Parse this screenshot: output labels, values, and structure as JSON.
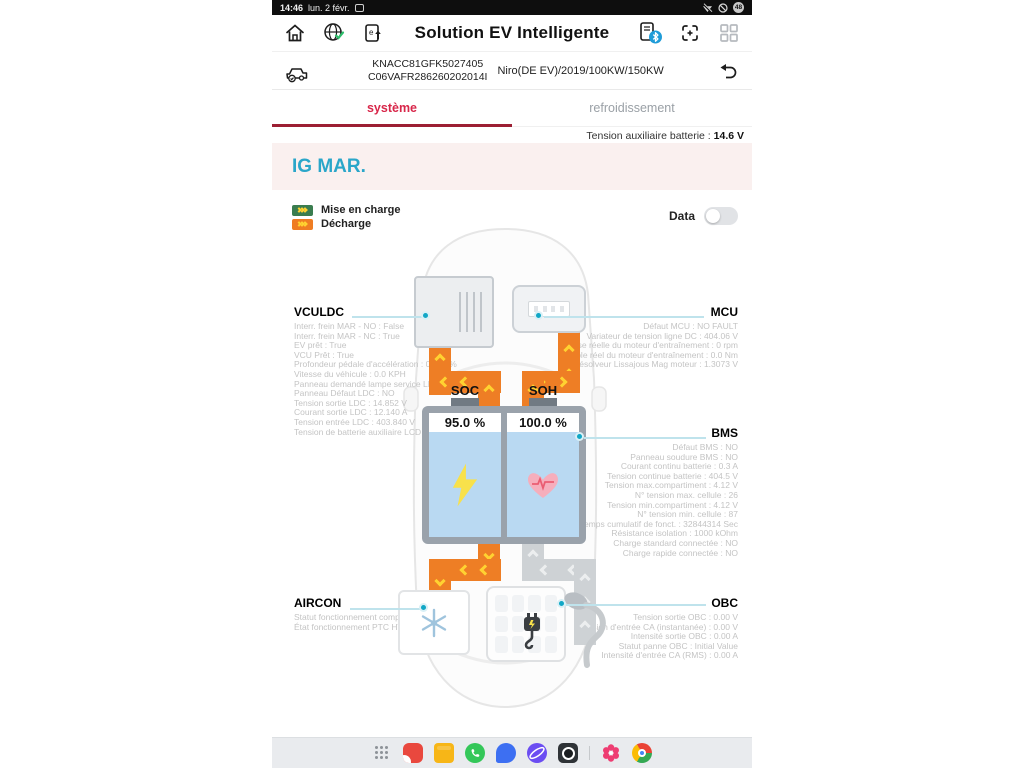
{
  "status_bar": {
    "time": "14:46",
    "date": "lun. 2 févr.",
    "battery": "48"
  },
  "header": {
    "title": "Solution EV Intelligente"
  },
  "vehicle_bar": {
    "vin_line1": "KNACC81GFK5027405",
    "vin_line2": "C06VAFR286260202014I",
    "model": "Niro(DE EV)/2019/100KW/150KW"
  },
  "tabs": {
    "system": "système",
    "cooling": "refroidissement"
  },
  "content": {
    "aux_battery_label": "Tension auxiliaire batterie :",
    "aux_battery_value": "14.6 V",
    "banner": "IG MAR.",
    "legend": {
      "charge": "Mise en charge",
      "discharge": "Décharge"
    },
    "data_toggle_label": "Data"
  },
  "components": {
    "vculdc": {
      "title": "VCULDC",
      "lines": [
        "Interr. frein MAR - NO : False",
        "Interr. frein MAR - NC : True",
        "EV prêt : True",
        "VCU Prêt : True",
        "Profondeur pédale d'accélération : 0.000 %",
        "Vitesse du véhicule : 0.0 KPH",
        "Panneau demandé lampe service LDC : OFF",
        "Panneau Défaut LDC : NO",
        "Tension sortie LDC : 14.852 V",
        "Courant sortie LDC : 12.140 A",
        "Tension entrée LDC : 403.840 V",
        "Tension de batterie auxiliaire LCD : 14.627 V"
      ]
    },
    "mcu": {
      "title": "MCU",
      "lines": [
        "Défaut MCU : NO FAULT",
        "Variateur de tension ligne DC : 404.06 V",
        "Vitesse réelle du moteur d'entraînement : 0 rpm",
        "Couple réel du moteur d'entraînement : 0.0 Nm",
        "Résolveur Lissajous Mag moteur : 1.3073 V"
      ]
    },
    "bms": {
      "title": "BMS",
      "lines": [
        "Défaut BMS : NO",
        "Panneau soudure BMS : NO",
        "Courant continu batterie : 0.3 A",
        "Tension continue batterie : 404.5 V",
        "Tension max.compartiment : 4.12 V",
        "N° tension max. cellule : 26",
        "Tension min.compartiment : 4.12 V",
        "N° tension min. cellule : 87",
        "Temps cumulatif de fonct. : 32844314 Sec",
        "Résistance isolation : 1000 kOhm",
        "Charge standard connectée : NO",
        "Charge rapide connectée : NO"
      ]
    },
    "aircon": {
      "title": "AIRCON",
      "lines": [
        "Statut fonctionnement compresseur : OFF",
        "État fonctionnement PTC HV : OFF"
      ]
    },
    "obc": {
      "title": "OBC",
      "lines": [
        "Tension sortie OBC : 0.00 V",
        "Tension d'entrée CA (instantanée) : 0.00 V",
        "Intensité sortie OBC : 0.00 A",
        "Statut panne OBC : Initial Value",
        "Intensité d'entrée CA (RMS) : 0.00 A"
      ]
    },
    "battery": {
      "soc_label": "SOC",
      "soc_value": "95.0 %",
      "soh_label": "SOH",
      "soh_value": "100.0 %"
    }
  },
  "colors": {
    "tab_active": "#d8274a",
    "tab_underline": "#9c1f33",
    "banner_text": "#2aa6c9",
    "banner_bg": "#faf0ef",
    "pipe_discharge": "#ee7e25",
    "pipe_inactive": "#ced2d5",
    "legend_charge": "#3a7d4f",
    "node_teal": "#11a7c6",
    "battery_cell": "#b9d9f2"
  },
  "dock": {
    "apps": [
      "apps-grid",
      "notes",
      "my-files",
      "phone",
      "messages",
      "internet",
      "camera",
      "galaxy-store",
      "chrome"
    ]
  }
}
